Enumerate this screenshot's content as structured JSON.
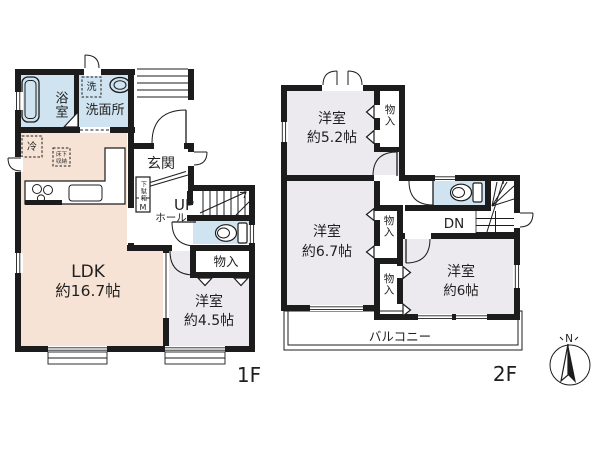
{
  "colors": {
    "wall": "#1c1c1c",
    "wet_room": "#cfe4f0",
    "ldk": "#f6e3d5",
    "bedroom": "#edeaef",
    "paper": "#ffffff"
  },
  "f1": {
    "floor_label": "1F",
    "bath": {
      "name": "浴室"
    },
    "washroom": {
      "name": "洗面所",
      "washer": "洗"
    },
    "entrance": {
      "name": "玄関"
    },
    "shoe_cabinet": {
      "name": "下駄箱",
      "meter": "M"
    },
    "hall": {
      "up": "UP",
      "name": "ホール"
    },
    "closet": {
      "name": "物入"
    },
    "ldk": {
      "name": "LDK",
      "size": "約16.7帖",
      "fridge": "冷",
      "floor_storage_1": "床下",
      "floor_storage_2": "収納"
    },
    "bedroom": {
      "name": "洋室",
      "size": "約4.5帖"
    }
  },
  "f2": {
    "floor_label": "2F",
    "bedroom_52": {
      "name": "洋室",
      "size": "約5.2帖"
    },
    "closet_top": {
      "name": "物入"
    },
    "bedroom_67": {
      "name": "洋室",
      "size": "約6.7帖"
    },
    "closet_mid": {
      "name": "物入"
    },
    "closet_low": {
      "name": "物入"
    },
    "bedroom_6": {
      "name": "洋室",
      "size": "約6帖"
    },
    "stairs": {
      "down": "DN"
    },
    "balcony": {
      "name": "バルコニー"
    }
  },
  "compass": {
    "north": "N"
  }
}
